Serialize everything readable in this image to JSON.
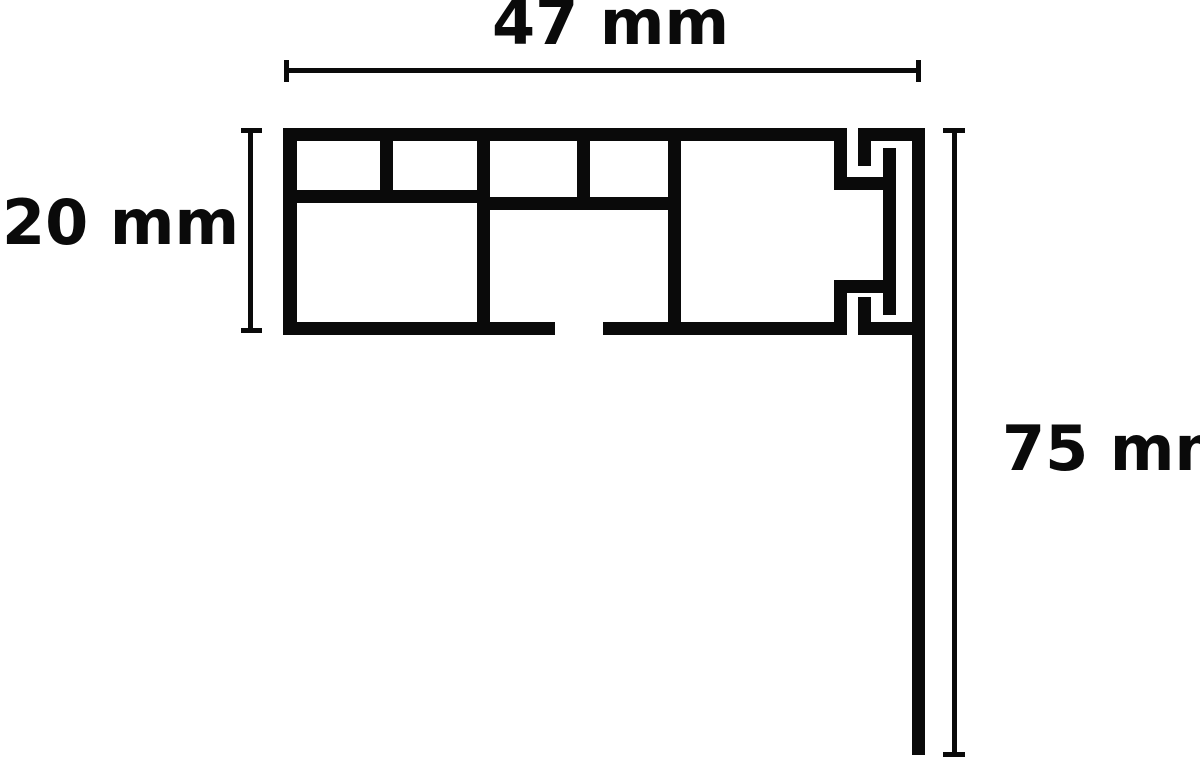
{
  "title": "Profile cross-section dimension diagram",
  "background": "#ffffff",
  "ink": "#0a0a0a",
  "dimensions": {
    "width": {
      "label": "47 mm",
      "value": 47,
      "unit": "mm"
    },
    "height": {
      "label": "20 mm",
      "value": 20,
      "unit": "mm"
    },
    "drop": {
      "label": "75 mm",
      "value": 75,
      "unit": "mm"
    }
  },
  "figure": {
    "stroke": 13,
    "rects": [
      {
        "name": "dim-width-line",
        "x": 285,
        "y": 68,
        "w": 636,
        "h": 5
      },
      {
        "name": "dim-width-tick-left",
        "x": 284,
        "y": 60,
        "w": 5,
        "h": 22
      },
      {
        "name": "dim-width-tick-right",
        "x": 916,
        "y": 60,
        "w": 5,
        "h": 22
      },
      {
        "name": "dim-height-line",
        "x": 248,
        "y": 130,
        "w": 5,
        "h": 203
      },
      {
        "name": "dim-height-tick-top",
        "x": 241,
        "y": 128,
        "w": 21,
        "h": 5
      },
      {
        "name": "dim-height-tick-bottom",
        "x": 241,
        "y": 328,
        "w": 21,
        "h": 5
      },
      {
        "name": "dim-drop-line",
        "x": 952,
        "y": 130,
        "w": 5,
        "h": 625
      },
      {
        "name": "dim-drop-tick-top",
        "x": 943,
        "y": 128,
        "w": 22,
        "h": 5
      },
      {
        "name": "dim-drop-tick-bottom",
        "x": 943,
        "y": 752,
        "w": 22,
        "h": 5
      },
      {
        "name": "profile-left-wall",
        "x": 283,
        "y": 128,
        "w": 14,
        "h": 207
      },
      {
        "name": "profile-top-bar",
        "x": 283,
        "y": 128,
        "w": 564,
        "h": 13
      },
      {
        "name": "profile-mid-line-left",
        "x": 283,
        "y": 190,
        "w": 207,
        "h": 13
      },
      {
        "name": "profile-mid-line-right",
        "x": 477,
        "y": 197,
        "w": 204,
        "h": 13
      },
      {
        "name": "profile-bottom-bar-left",
        "x": 283,
        "y": 322,
        "w": 272,
        "h": 13
      },
      {
        "name": "profile-bottom-bar-right",
        "x": 603,
        "y": 322,
        "w": 244,
        "h": 13
      },
      {
        "name": "profile-divider-small-1",
        "x": 380,
        "y": 128,
        "w": 13,
        "h": 75
      },
      {
        "name": "profile-divider-full-1",
        "x": 477,
        "y": 128,
        "w": 13,
        "h": 207
      },
      {
        "name": "profile-divider-small-2",
        "x": 577,
        "y": 128,
        "w": 13,
        "h": 82
      },
      {
        "name": "profile-divider-full-2",
        "x": 668,
        "y": 128,
        "w": 13,
        "h": 207
      },
      {
        "name": "clip-wall-stub-top",
        "x": 834,
        "y": 128,
        "w": 13,
        "h": 62
      },
      {
        "name": "clip-hook-top-horizontal",
        "x": 834,
        "y": 177,
        "w": 53,
        "h": 13
      },
      {
        "name": "cover-top-bar",
        "x": 858,
        "y": 128,
        "w": 67,
        "h": 13
      },
      {
        "name": "cover-leg-top",
        "x": 858,
        "y": 141,
        "w": 13,
        "h": 25
      },
      {
        "name": "clip-middle-bar",
        "x": 883,
        "y": 148,
        "w": 13,
        "h": 167
      },
      {
        "name": "clip-wall-stub-bottom",
        "x": 834,
        "y": 280,
        "w": 13,
        "h": 55
      },
      {
        "name": "clip-hook-bottom-horizontal",
        "x": 834,
        "y": 280,
        "w": 53,
        "h": 13
      },
      {
        "name": "cover-bottom-bar",
        "x": 858,
        "y": 322,
        "w": 67,
        "h": 13
      },
      {
        "name": "cover-leg-bottom",
        "x": 858,
        "y": 297,
        "w": 13,
        "h": 25
      },
      {
        "name": "fascia-wall",
        "x": 912,
        "y": 128,
        "w": 13,
        "h": 627
      }
    ]
  }
}
